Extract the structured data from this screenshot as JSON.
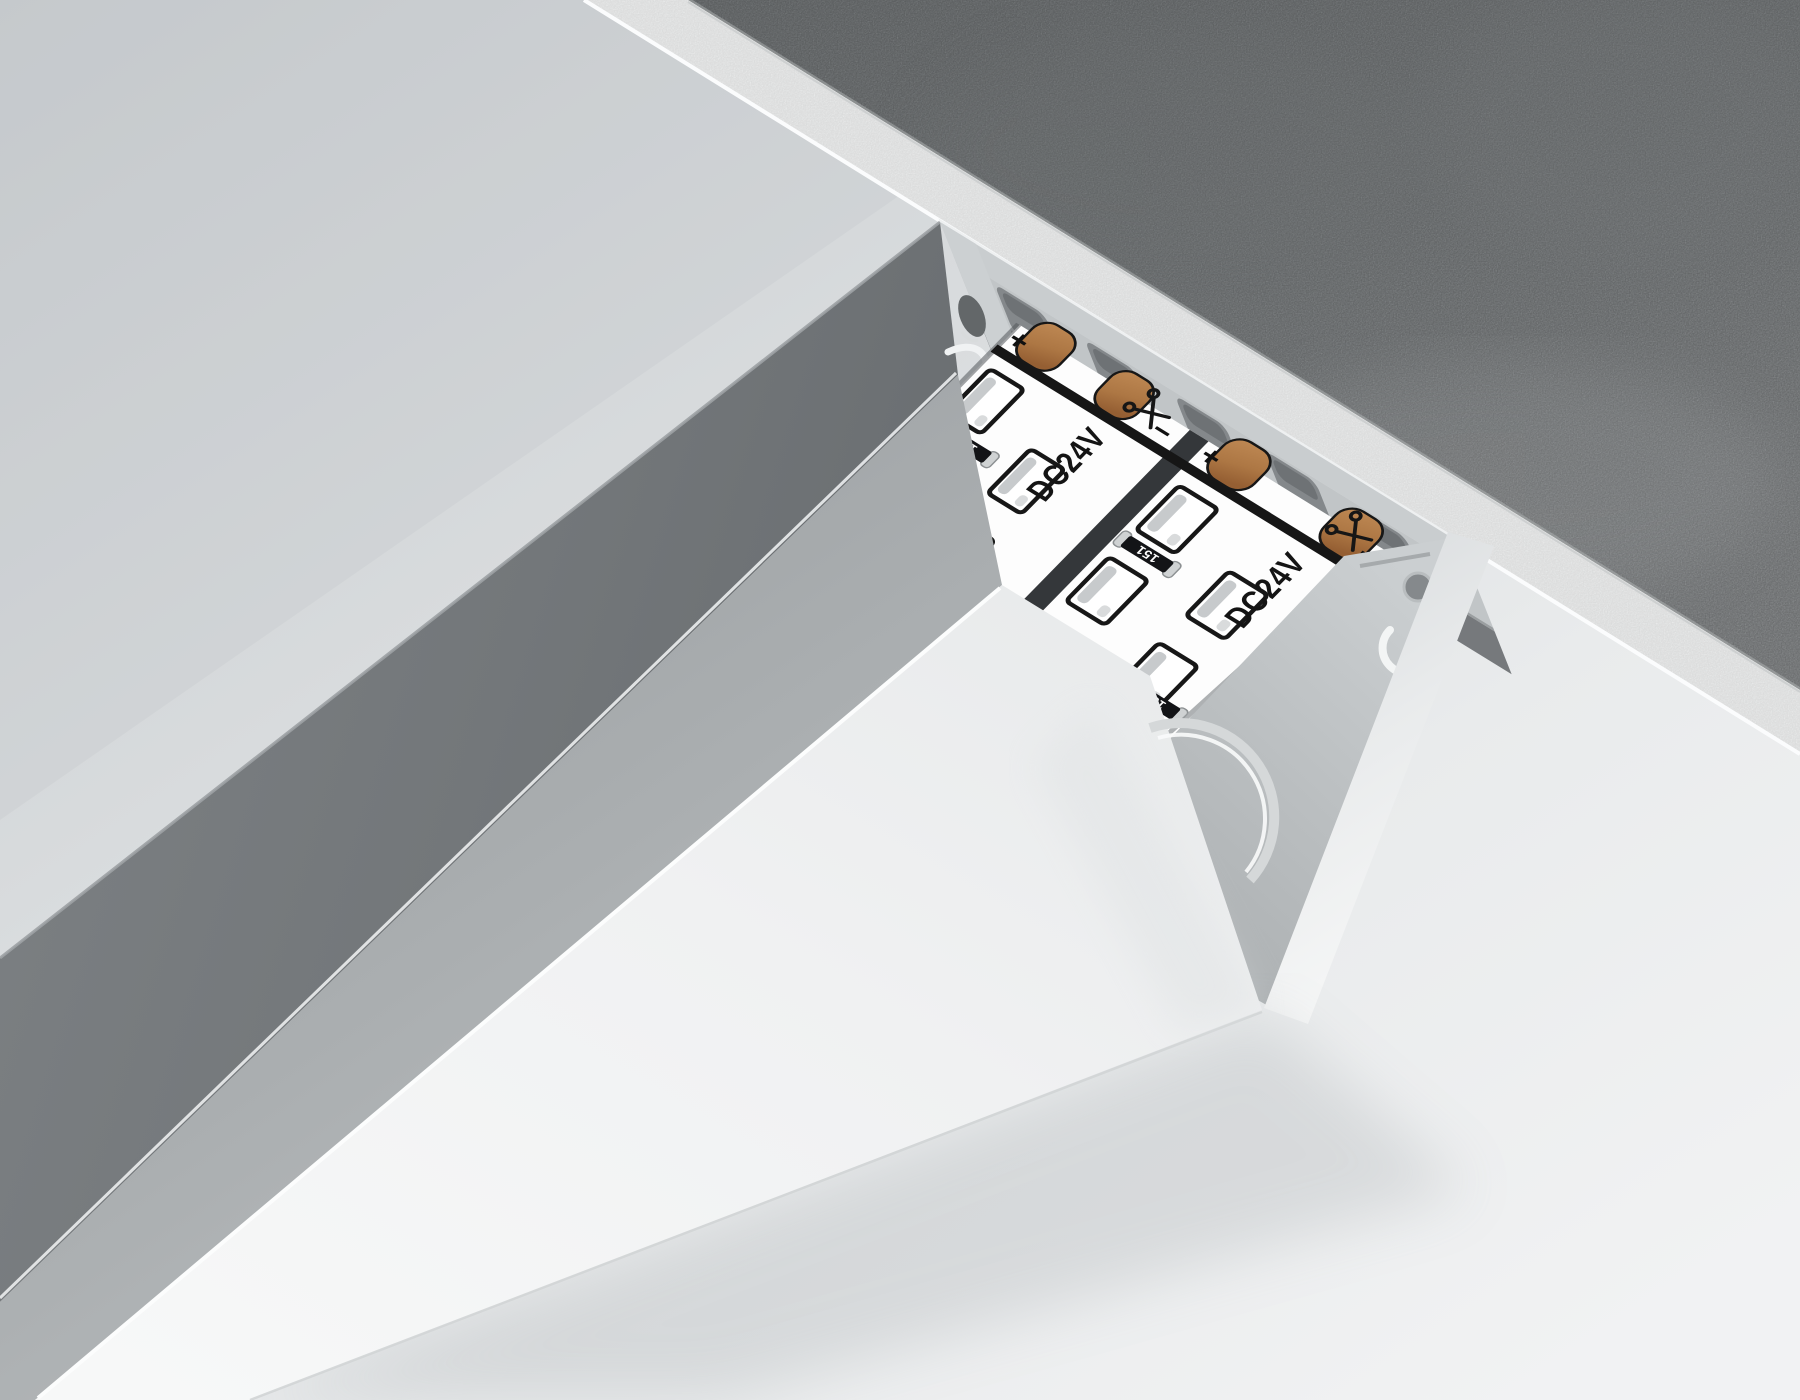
{
  "scene": {
    "surfaces": {
      "concrete_ceiling_color": "#8d9193",
      "plaster_edge_color": "#eff1f1",
      "wall_color_top": "#c9cdd0",
      "wall_color_bottom": "#f0f1f2",
      "profile_top_face_color": "#75797c",
      "profile_side_face_color": "#a9adb0",
      "diffuser_color": "#f1f2f3",
      "aluminum_cut_color": "#c7cbcd",
      "pcb_color": "#ffffff",
      "strip_gap_color": "#34373a",
      "copper_pad_color": "#b5804e",
      "resistor_body_color": "#121316"
    },
    "led_strips": [
      {
        "voltage_label": "DC24V",
        "brand_label": "AMBRELLA LIGHT",
        "polarity_positive": "+",
        "polarity_negative": "−",
        "resistor_labels": [
          "151",
          "151"
        ]
      },
      {
        "voltage_label": "DC24V",
        "brand_label": "AMBRELLA LIGHT",
        "polarity_positive": "+",
        "polarity_negative": "−",
        "resistor_labels": [
          "151",
          "151"
        ]
      }
    ],
    "icons": {
      "scissors_icon": "cut-here scissors mark",
      "brand_logo_icon": "round Ambrella Light logo",
      "keyhole_icon": "keyhole mounting slot"
    }
  }
}
